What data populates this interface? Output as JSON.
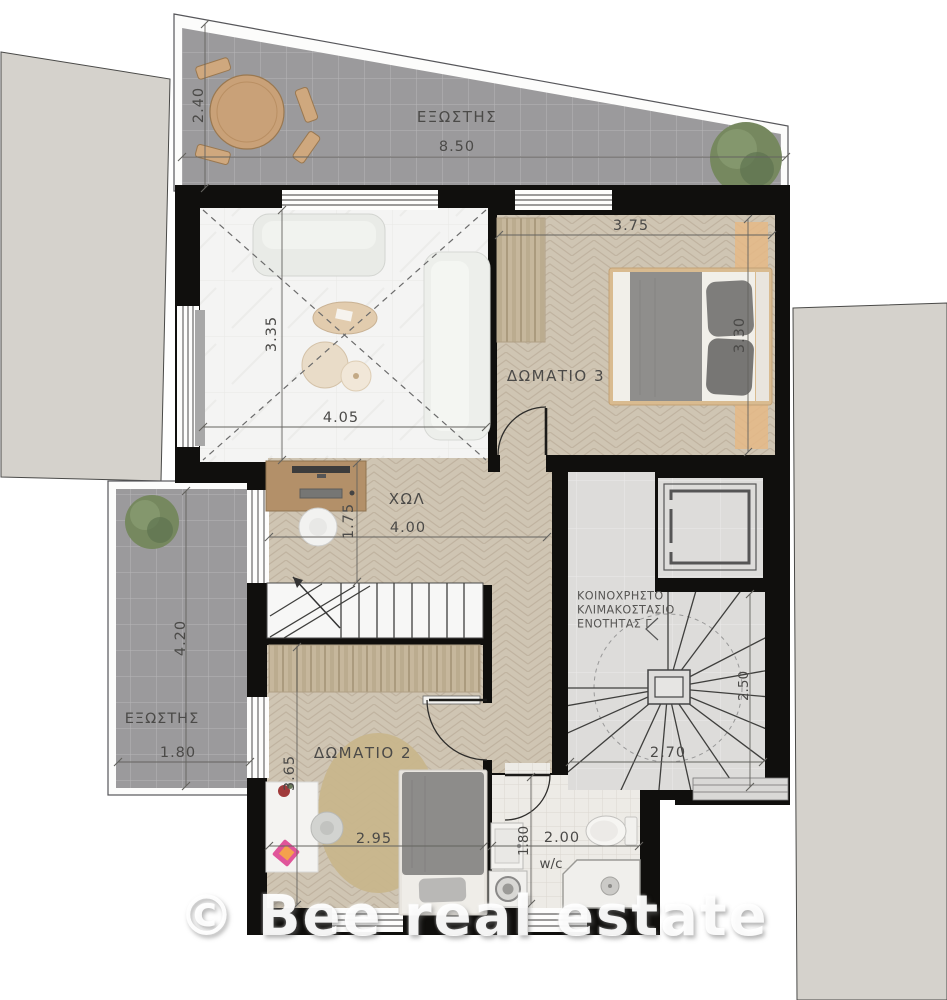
{
  "watermark": "© Bee real estate",
  "plan": {
    "balcony_top": {
      "name": "ΕΞΩΣΤΗΣ",
      "width": "8.50",
      "depth": "2.40"
    },
    "living_room": {
      "width": "4.05",
      "height": "3.35"
    },
    "bedroom3": {
      "name": "ΔΩΜΑΤΙΟ 3",
      "width": "3.75",
      "height": "3.30"
    },
    "hall": {
      "name": "ΧΩΛ",
      "width": "4.00",
      "height": "1.75"
    },
    "balcony_left": {
      "name": "ΕΞΩΣΤΗΣ",
      "width": "1.80",
      "height": "4.20"
    },
    "bedroom2": {
      "name": "ΔΩΜΑΤΙΟ 2",
      "width": "2.95",
      "height": "3.65"
    },
    "wc": {
      "name": "w/c",
      "width": "2.00",
      "height": "1.80"
    },
    "common_stairs": {
      "name_line1": "ΚΟΙΝΟΧΡΗΣΤΟ",
      "name_line2": "ΚΛΙΜΑΚΟΣΤΑΣΙΟ",
      "name_line3": "ΕΝΟΤΗΤΑΣ Γ",
      "width": "2.70",
      "height": "2.50"
    }
  },
  "colors": {
    "wall": "#100f0d",
    "wood": "#cfc5b3",
    "tile": "#9b9a9c",
    "marble": "#f4f4f3",
    "common": "#dddcda",
    "wcfloor": "#edebe6",
    "neighbor": "#d5d2cc",
    "text": "#4b4a48",
    "accentwood": "#c9a178",
    "watermark": "rgba(255,255,255,0.93)"
  }
}
